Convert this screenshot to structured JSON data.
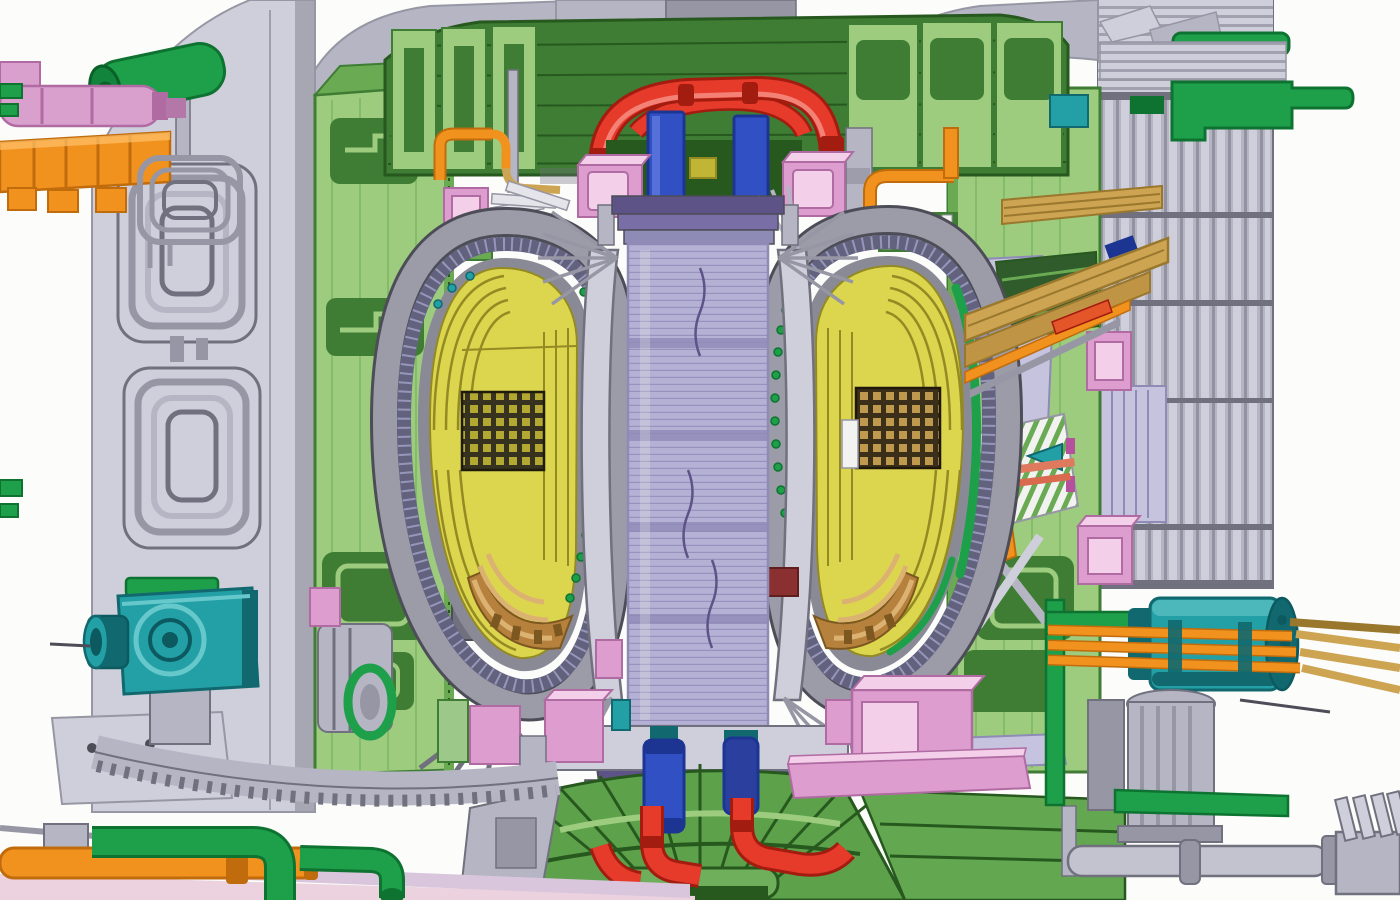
{
  "figure": {
    "type": "engineering-cutaway-render",
    "subject": "tokamak-fusion-reactor-cross-section",
    "text_labels": []
  },
  "palette": {
    "bg": "#fcfcfa",
    "grey0": "#e4e4ea",
    "grey1": "#cfcfdb",
    "grey2": "#b5b5c4",
    "grey3": "#9696a4",
    "grey4": "#70707e",
    "grey5": "#4d4d58",
    "lav1": "#b4b1d5",
    "lav2": "#8e8bb6",
    "pur1": "#7a6ea7",
    "pur2": "#5e5387",
    "wedge": "#c6c3df",
    "gl": "#9dcc7f",
    "gm": "#69aa53",
    "gd": "#3e7d33",
    "gdd": "#27591f",
    "dgslab": "#2f5c2a",
    "pg": "#1ea04b",
    "pgd": "#0e7331",
    "y1": "#dcd54e",
    "y2": "#c0b534",
    "y3": "#938a24",
    "vessel": "#9c9ca9",
    "shield": "#62627f",
    "sdot": "#a0a0c4",
    "gapgrey": "#8a8a96",
    "pink1": "#f3cfe9",
    "pink2": "#dd9ecf",
    "pink3": "#b06ba2",
    "mauve": "#d9a0ce",
    "mag": "#b4509c",
    "or1": "#f2921e",
    "or2": "#c06c0c",
    "orlt": "#ffc26a",
    "tan1": "#cda452",
    "tan2": "#99782e",
    "br1": "#b5813d",
    "br2": "#7c5720",
    "brlt": "#dcb272",
    "red1": "#e63a2a",
    "red2": "#a31c10",
    "redhl": "#f58a7e",
    "coral": "#e07a5e",
    "blue1": "#3050c4",
    "blue2": "#1c3593",
    "teal1": "#23a0a6",
    "teal2": "#11696f",
    "teal3": "#67c8cc",
    "rose": "#ecd2de",
    "lilac": "#d9c6dc",
    "whitec": "#f2f2f0",
    "grid1": "#37321f",
    "grid2": "#3c2f1a",
    "maroon": "#8a3030"
  },
  "components": [
    {
      "name": "cryostat-dome",
      "color": "grey2"
    },
    {
      "name": "cryostat-left-wall",
      "color": "grey1"
    },
    {
      "name": "cryostat-right-ribbed-wall",
      "color": "grey2"
    },
    {
      "name": "cooling-pipe-loop-frames",
      "color": "grey3"
    },
    {
      "name": "toroidal-field-coil-left",
      "color": "gl"
    },
    {
      "name": "toroidal-field-coil-right",
      "color": "gl"
    },
    {
      "name": "upper-coil-crown",
      "color": "gd"
    },
    {
      "name": "central-solenoid",
      "color": "lav1"
    },
    {
      "name": "solenoid-cooling-ring",
      "color": "red1"
    },
    {
      "name": "vacuum-vessel-left",
      "color": "vessel"
    },
    {
      "name": "vacuum-vessel-right",
      "color": "vessel"
    },
    {
      "name": "thermal-shield-band",
      "color": "shield"
    },
    {
      "name": "blanket-modules",
      "color": "y1"
    },
    {
      "name": "equatorial-port-grid",
      "color": "grid1"
    },
    {
      "name": "divertor-cassettes",
      "color": "br1"
    },
    {
      "name": "heating-beam-ducts",
      "color": "tan1"
    },
    {
      "name": "diagnostic-port-plug",
      "color": "teal1"
    },
    {
      "name": "neutral-beam-feedthrough",
      "color": "teal1"
    },
    {
      "name": "busbar-conductors",
      "color": "or1"
    },
    {
      "name": "cryo-feed-pipes",
      "color": "pg"
    },
    {
      "name": "magnet-feeder-boxes",
      "color": "pink2"
    },
    {
      "name": "base-support-ring",
      "color": "gm"
    },
    {
      "name": "floor-slab",
      "color": "rose"
    }
  ]
}
